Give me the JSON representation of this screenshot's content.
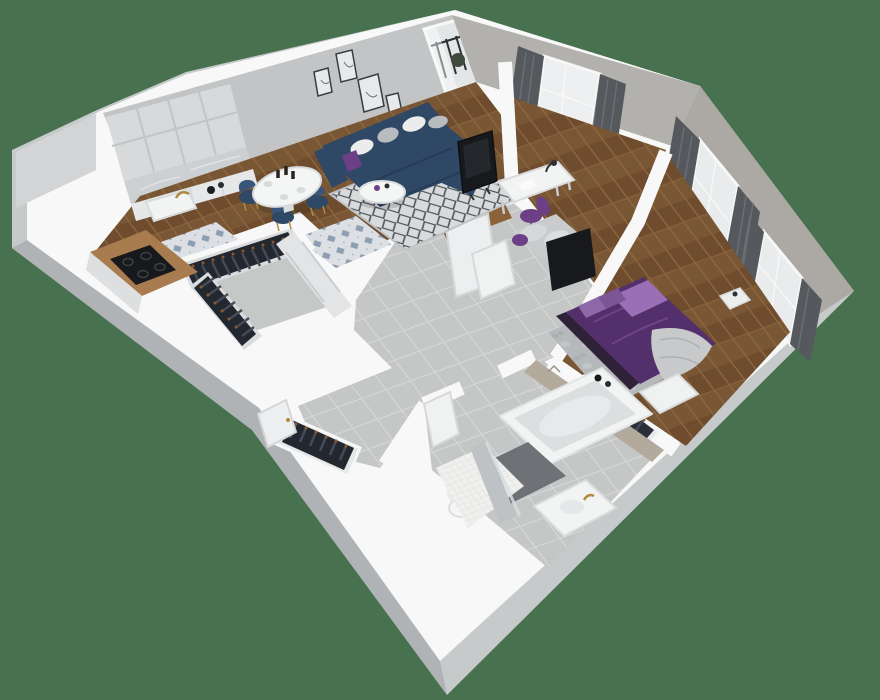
{
  "scene": {
    "type": "3d-apartment-floor-plan-render",
    "background": "#48714F",
    "palette": {
      "wall_top": "#F7F8F7",
      "wall_side": "#C7CACB",
      "wall_side_dark": "#AFB3B5",
      "wall_face_nw": "#C2C4C6",
      "wall_face_n": "#B3B1AE",
      "wall_face_e": "#ACA8A3",
      "wood_floor": "#7A5734",
      "wood_floor_dark": "#66492C",
      "tile_grey": "#C5C7C6",
      "tile_grout": "#D8DADA",
      "closet_floor": "#C6C8C8",
      "rug_light": "#D9DADB",
      "rug_pattern": "#4E545C",
      "bedroom_rug": "#B6B9BB",
      "sofa_navy": "#2F4866",
      "sofa_navy_dark": "#263C57",
      "chair_navy": "#2F4866",
      "pillow_white": "#ECECEC",
      "pillow_grey": "#B9BCBF",
      "accent_purple": "#6C3F86",
      "bed_purple": "#53306B",
      "bed_purple_light": "#9A6FB5",
      "pillow_lavender": "#8E68A8",
      "blanket_grey": "#C7C9CB",
      "clothes_dark": "#232A36",
      "clothes_mid": "#454C58",
      "hanger_brown": "#8A5A2E",
      "counter_wood": "#A97C4F",
      "wardrobe_wood": "#8A6138",
      "cabinet_white": "#E6E7E9",
      "cabinet_grey": "#D7D9DA",
      "marble": "#CDD0D2",
      "cooktop_black": "#17191C",
      "tv_black": "#17191C",
      "curtain_dark": "#55585C",
      "curtain_fold": "#6A6E72",
      "window_glass": "#E9EBEC",
      "gold": "#B08A3E",
      "white_fixture": "#F2F3F3",
      "bath_mat": "#6E7277",
      "chevron_tile": "#B3A99C",
      "plant_green": "#3E4A3C"
    },
    "rooms": [
      {
        "name": "kitchen",
        "items": [
          "upper-cabinets",
          "marble-backsplash",
          "sink",
          "gold-faucet",
          "wood-countertop",
          "cooktop",
          "base-cabinets",
          "patterned-tile-floor"
        ]
      },
      {
        "name": "living-room",
        "items": [
          "corner-sofa",
          "throw-pillows",
          "coffee-table",
          "tv",
          "area-rug",
          "wall-art",
          "balcony-door",
          "balcony-railing",
          "plant"
        ]
      },
      {
        "name": "dining-area",
        "items": [
          "round-table",
          "dining-chairs",
          "bottles",
          "plates"
        ]
      },
      {
        "name": "walk-in-closet",
        "items": [
          "clothes-rack",
          "clothes-rack",
          "wardrobe-doors"
        ]
      },
      {
        "name": "office-nook",
        "items": [
          "desk",
          "desk-lamp",
          "desk-chair",
          "daybed",
          "window",
          "curtains",
          "open-wardrobe"
        ]
      },
      {
        "name": "bedroom",
        "items": [
          "double-bed",
          "pillows",
          "blanket",
          "area-rug",
          "bench",
          "clothes-rack",
          "nightstand",
          "tv-panel",
          "windows",
          "curtains"
        ]
      },
      {
        "name": "hallway",
        "items": [
          "tile-floor",
          "interior-doors"
        ]
      },
      {
        "name": "entry",
        "items": [
          "coat-rack",
          "front-door"
        ]
      },
      {
        "name": "bathroom",
        "items": [
          "bathtub",
          "bottles",
          "bath-mat",
          "vanity",
          "gold-faucet",
          "toilet",
          "walk-in-shower",
          "glass-screen",
          "door"
        ]
      }
    ]
  }
}
